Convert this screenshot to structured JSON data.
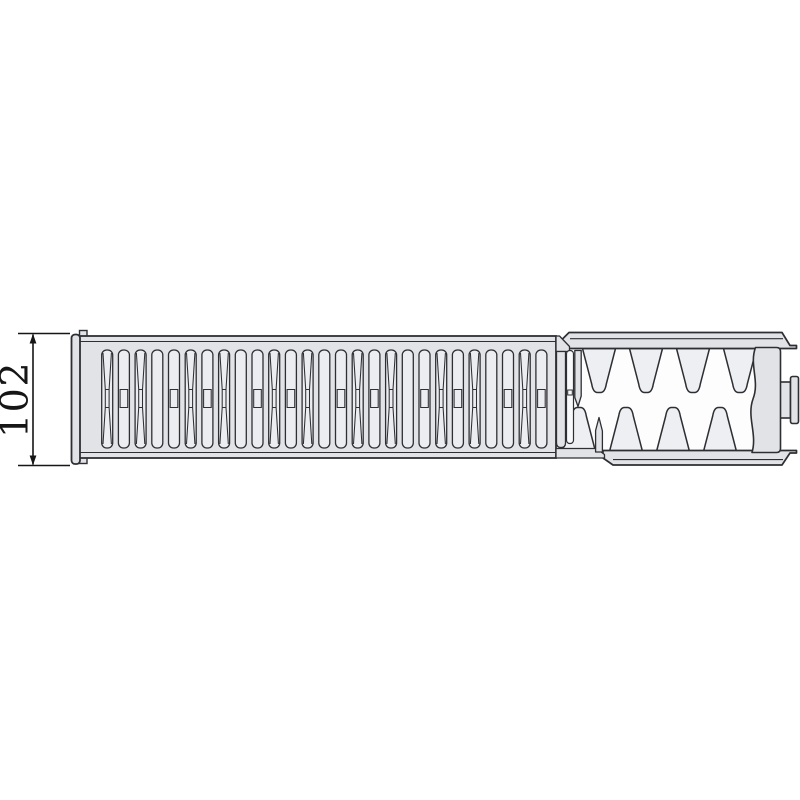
{
  "diagram": {
    "title": "radiator-profile-side-section-drawing",
    "dimension": {
      "label": "102"
    },
    "colors": {
      "background": "#ffffff",
      "outline": "#2e2f33",
      "body_fill": "#e2e3e7",
      "slot_fill": "#ecedf0",
      "torn_slot_fill": "#f8f9fb",
      "fin_fill": "#edeff2",
      "fin_area_fill": "#fdfdfe",
      "dimension_color": "#161616"
    },
    "geometry": {
      "grille": {
        "slot_count": 27,
        "first_slot_x": 101.7,
        "pitch": 16.7,
        "slot_width": 11,
        "slot_top": 350,
        "slot_height": 98,
        "slot_radius": 5,
        "pattern_cycle": [
          "hourglass",
          "waistbox",
          "hourglass",
          "plain",
          "waistbox"
        ]
      },
      "fins": {
        "top_centers": [
          552,
          599,
          646,
          693,
          740
        ],
        "bottom_centers": [
          579,
          626,
          673,
          720
        ],
        "base_half_width": 16.5,
        "top_base_y": 348.5,
        "top_tip_y": 392.5,
        "bottom_base_y": 451.5,
        "bottom_tip_y": 407.5
      },
      "dimension": {
        "tick_y_top": 333.5,
        "tick_y_bottom": 465.5,
        "tick_x1": 18,
        "tick_x2": 70,
        "line_x": 33,
        "label_x": 27.5,
        "label_y": 399.5
      }
    }
  }
}
